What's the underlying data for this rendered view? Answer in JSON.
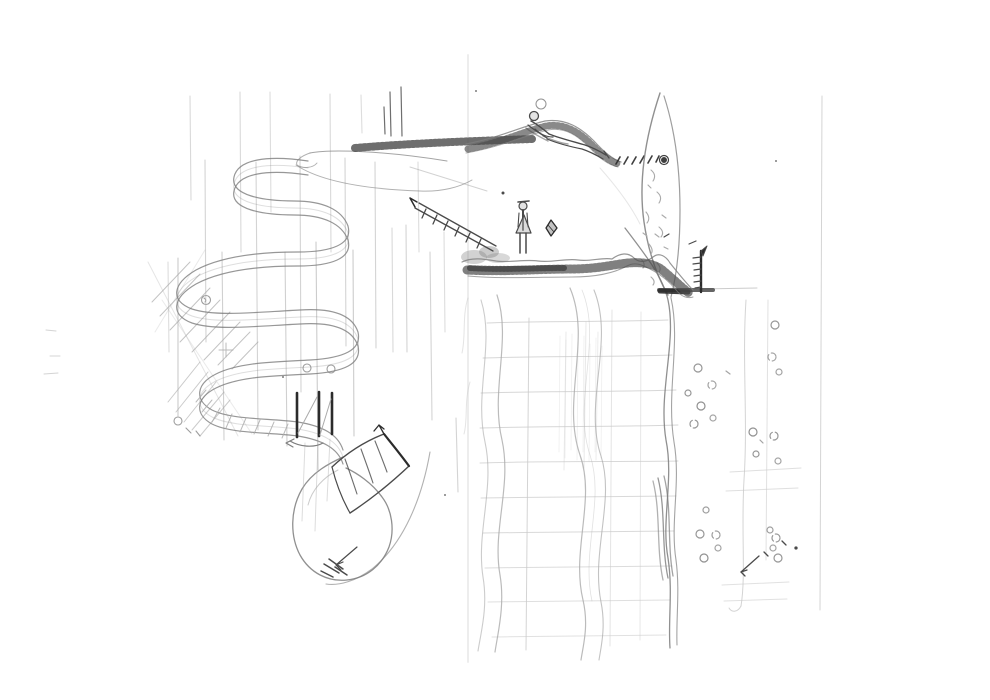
{
  "meta": {
    "title": "Pencil sketch - side-view landscape / level concept",
    "medium": "graphite pencil on white paper",
    "canvas": {
      "width": 990,
      "height": 700
    }
  },
  "palette": {
    "paper": "#ffffff",
    "seam": "#ebebeb",
    "pencil_faint": "#c9c9c9",
    "pencil_light": "#aaaaaa",
    "pencil_mid": "#7d7d7d",
    "pencil_dark": "#4a4a4a",
    "pencil_black": "#2b2b2b"
  },
  "scene": {
    "description": "Hand-drawn graphite sketch: winding serpentine slide on the left with tall reed strokes, a hatched plateau and hill ridge on top, a reclining figure on the ridge, a dashed trail to a dark hole, a leaf-shaped cave wall, a standing figure on a hatched ledge with a floating gem and diagonal ladder, a tick pole on a small platform, a looping slide end with rail and arrows, faint construction grid, wavy water ribbons and scattered bubbles below right.",
    "elements": [
      {
        "id": "upper-plateau",
        "label": "flat hatched plateau with thin reeds",
        "x": 400,
        "y": 145
      },
      {
        "id": "hill-ridge",
        "label": "hatched hill ridge",
        "x": 545,
        "y": 125
      },
      {
        "id": "reclining-figure",
        "label": "small figure reclining on the ridge, circle above head",
        "x": 560,
        "y": 130
      },
      {
        "id": "footprint-trail",
        "label": "dashed slanted trail ending in a dark filled hole",
        "x": 640,
        "y": 160
      },
      {
        "id": "cave-wall",
        "label": "leaf-shaped cave wall with curved inner hatching",
        "x": 660,
        "y": 195
      },
      {
        "id": "tick-pole",
        "label": "dark pole with rung ticks standing on a small platform",
        "x": 701,
        "y": 270
      },
      {
        "id": "mid-ledge",
        "label": "wavy hatched ledge descending to the right",
        "x": 570,
        "y": 265
      },
      {
        "id": "standing-figure",
        "label": "small standing figure with cap and coat",
        "x": 523,
        "y": 228
      },
      {
        "id": "floating-gem",
        "label": "small floating diamond shape",
        "x": 551,
        "y": 228
      },
      {
        "id": "diagonal-ladder",
        "label": "diagonal ladder with rungs and a small flag at top",
        "x": 455,
        "y": 227
      },
      {
        "id": "serpentine-slide",
        "label": "large winding S-curve slide band",
        "x": 270,
        "y": 300
      },
      {
        "id": "reed-lines",
        "label": "many tall vertical reed strokes crossing the slide",
        "x": 300,
        "y": 280
      },
      {
        "id": "hatch-patches",
        "label": "diagonal shading patches and small circles on the left",
        "x": 200,
        "y": 330
      },
      {
        "id": "posts",
        "label": "three dark vertical posts over the band",
        "x": 316,
        "y": 414
      },
      {
        "id": "curved-rail",
        "label": "curved rail / ladder segment with upward arrow",
        "x": 370,
        "y": 470
      },
      {
        "id": "slide-loop",
        "label": "looping end of the slide with scribble and arrow",
        "x": 344,
        "y": 520
      },
      {
        "id": "construction-grid",
        "label": "faint construction grid of horizontals and verticals",
        "x": 580,
        "y": 480
      },
      {
        "id": "water-ribbons",
        "label": "wavy vertical water ribbons flowing downward",
        "x": 580,
        "y": 470
      },
      {
        "id": "bubbles",
        "label": "scattered small bubble circles with tick marks and arrow",
        "x": 740,
        "y": 450
      },
      {
        "id": "guide-lines",
        "label": "long faint vertical guide lines on the right",
        "x": 800,
        "y": 350
      }
    ]
  }
}
